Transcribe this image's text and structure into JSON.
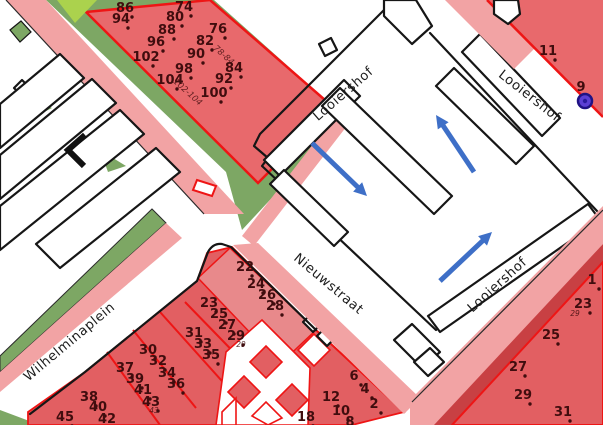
{
  "map": {
    "street_labels": [
      {
        "id": "wilhelminaplein",
        "text": "Wilhelminaplein",
        "x": 72,
        "y": 345,
        "rot": -40
      },
      {
        "id": "nieuwstraat",
        "text": "Nieuwstraat",
        "x": 326,
        "y": 287,
        "rot": 40
      },
      {
        "id": "looiershof-center",
        "text": "Looiershof",
        "x": 346,
        "y": 97,
        "rot": -41
      },
      {
        "id": "looiershof-northeast",
        "text": "Looiershof",
        "x": 527,
        "y": 99,
        "rot": 38
      },
      {
        "id": "looiershof-east",
        "text": "Looiershof",
        "x": 500,
        "y": 288,
        "rot": -42
      }
    ],
    "house_number_groups": [
      {
        "name": "looiershof-north-parcel",
        "dots": true,
        "numbers": [
          [
            "86",
            125,
            8
          ],
          [
            "74",
            184,
            7
          ],
          [
            "94",
            121,
            19
          ],
          [
            "80",
            175,
            17
          ],
          [
            "88",
            167,
            30
          ],
          [
            "76",
            218,
            29
          ],
          [
            "96",
            156,
            42
          ],
          [
            "82",
            205,
            41
          ],
          [
            "102",
            146,
            57
          ],
          [
            "90",
            196,
            54
          ],
          [
            "98",
            184,
            69
          ],
          [
            "84",
            234,
            68
          ],
          [
            "104",
            170,
            80
          ],
          [
            "92",
            224,
            79
          ],
          [
            "100",
            214,
            93
          ]
        ]
      },
      {
        "name": "northeast-parcel",
        "dots": true,
        "numbers": [
          [
            "11",
            548,
            51
          ],
          [
            "9",
            581,
            87,
            1
          ]
        ]
      },
      {
        "name": "east-parcel",
        "dots": true,
        "numbers": [
          [
            "1",
            592,
            280
          ],
          [
            "23",
            583,
            304
          ],
          [
            "25",
            551,
            335
          ],
          [
            "27",
            518,
            367
          ],
          [
            "29",
            523,
            395
          ],
          [
            "31",
            563,
            412
          ]
        ]
      },
      {
        "name": "wilhelminaplein-parcels",
        "dots": true,
        "numbers": [
          [
            "22",
            245,
            267
          ],
          [
            "24",
            256,
            284
          ],
          [
            "26",
            267,
            295
          ],
          [
            "28",
            275,
            306
          ],
          [
            "23",
            209,
            303
          ],
          [
            "25",
            219,
            314
          ],
          [
            "27",
            227,
            325
          ],
          [
            "29",
            236,
            336
          ],
          [
            "31",
            194,
            333
          ],
          [
            "33",
            203,
            344
          ],
          [
            "35",
            211,
            355
          ],
          [
            "30",
            148,
            350
          ],
          [
            "32",
            158,
            361
          ],
          [
            "34",
            167,
            373
          ],
          [
            "36",
            176,
            384
          ],
          [
            "37",
            125,
            368
          ],
          [
            "39",
            135,
            379
          ],
          [
            "41",
            143,
            390
          ],
          [
            "43",
            151,
            402
          ],
          [
            "38",
            89,
            397
          ],
          [
            "40",
            98,
            407
          ],
          [
            "42",
            107,
            419
          ],
          [
            "45",
            65,
            417
          ]
        ]
      },
      {
        "name": "nieuwstraat-complex",
        "dots": true,
        "numbers": [
          [
            "18",
            306,
            417
          ],
          [
            "12",
            331,
            397
          ],
          [
            "10",
            341,
            411
          ],
          [
            "8",
            350,
            422
          ],
          [
            "6",
            354,
            376
          ],
          [
            "4",
            365,
            389
          ],
          [
            "2",
            374,
            404
          ]
        ]
      }
    ],
    "range_labels": [
      {
        "text": "78-84",
        "x": 222,
        "y": 57,
        "rot": 42
      },
      {
        "text": "102-104",
        "x": 186,
        "y": 94,
        "rot": 42
      }
    ],
    "small_numbers": [
      {
        "text": "43",
        "x": 154,
        "y": 413
      },
      {
        "text": "29",
        "x": 241,
        "y": 347
      },
      {
        "text": "29",
        "x": 575,
        "y": 316
      }
    ],
    "arrows": [
      {
        "x1": 312,
        "y1": 143,
        "x2": 367,
        "y2": 196
      },
      {
        "x1": 474,
        "y1": 172,
        "x2": 436,
        "y2": 115
      },
      {
        "x1": 440,
        "y1": 281,
        "x2": 492,
        "y2": 232
      }
    ],
    "marker": {
      "x": 585,
      "y": 101,
      "r": 7,
      "color": "#5b3fd4",
      "ring": "#1f1284"
    },
    "colors": {
      "parcel_red": "#e8696c",
      "parcel_red_dark": "#e25f62",
      "parcel_red_light": "#e8898b",
      "border_red": "#ee1515",
      "sidewalk_pink": "#f2a3a4",
      "green": "#7da764",
      "lime": "#abd24d",
      "dark_red_strip": "#c84043",
      "arrow_blue": "#3e6fc7",
      "number_color": "#400d0e",
      "label_color": "#1c1c1c",
      "outline_black": "#161616"
    }
  }
}
